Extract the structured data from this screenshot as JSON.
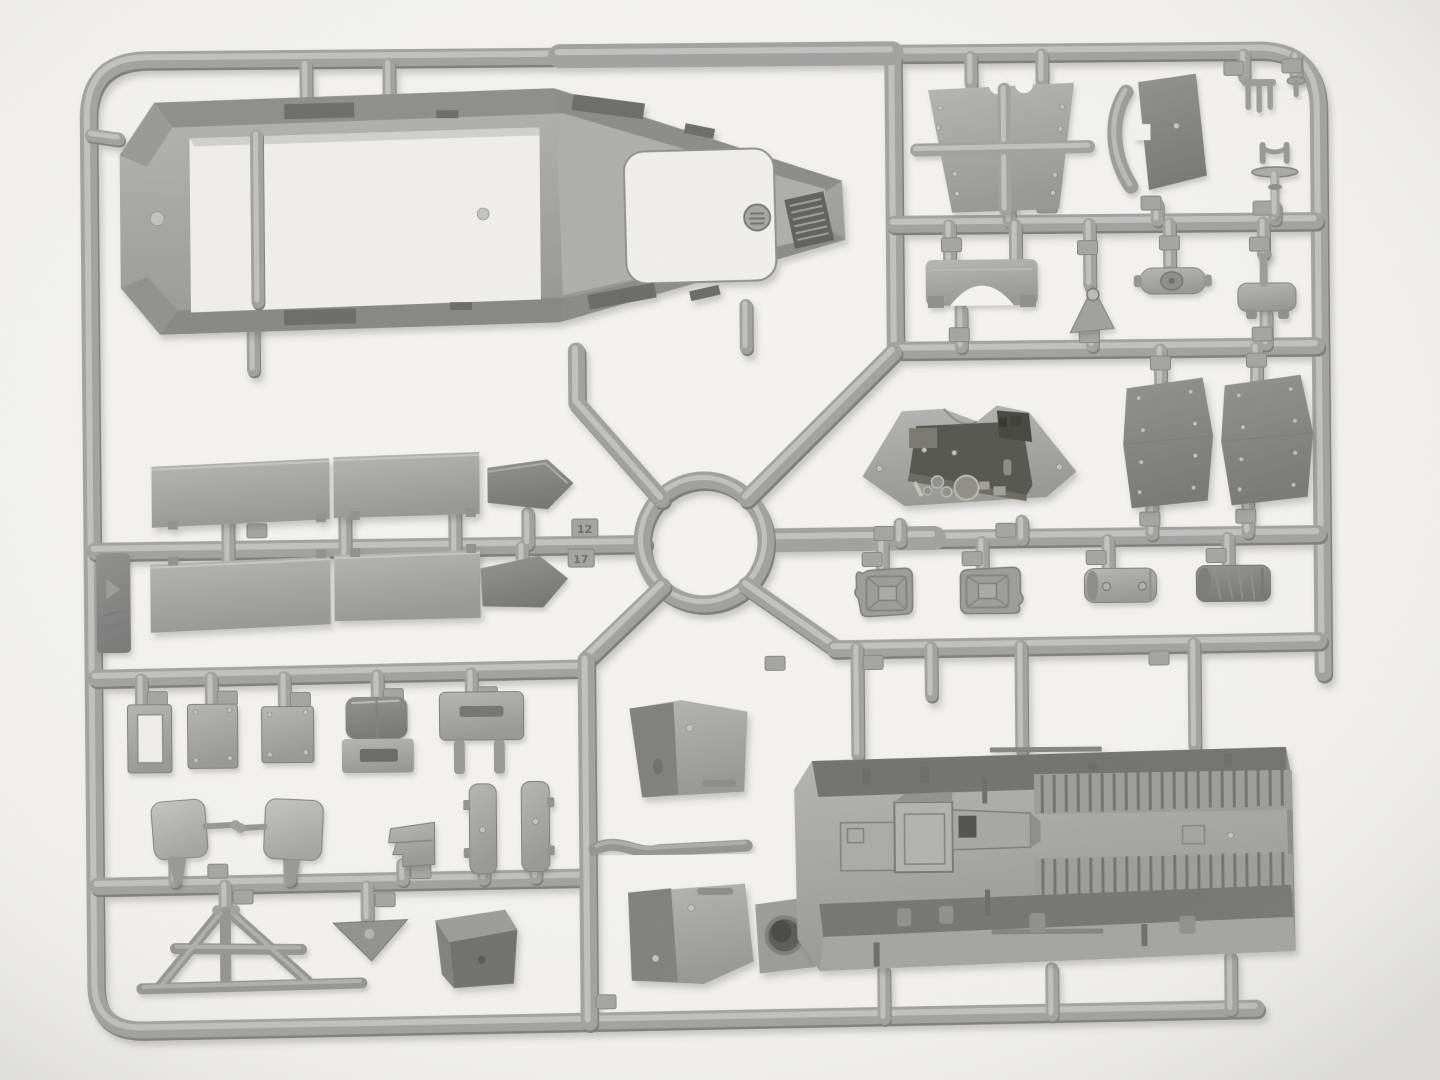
{
  "meta": {
    "description": "Product photograph of a gray injection-molded polystyrene model-kit sprue (parts frame) lying on a white background, soft studio light, subtle shadows under every part",
    "orientation": "landscape"
  },
  "palette": {
    "bg": "#f3f2f0",
    "base": "#a0a09e",
    "hi": "#c6c6c4",
    "mid": "#929290",
    "lo": "#7b7b79",
    "dark": "#666664",
    "open": "#efeeec",
    "vignette": "rgba(70,70,68,0.10)"
  },
  "sprue": {
    "material": "neutral gray styrene",
    "frame_shape": "rounded rectangular frame with internal runners, a central circular ring junction and four diagonal spokes",
    "tags": {
      "upper": "12",
      "lower": "17"
    },
    "parts": [
      {
        "id": "hull-roof-panel",
        "name": "large armored hull top panel with open interior and engine grille"
      },
      {
        "id": "windscreen-frame-plate",
        "name": "trapezoidal visor plate with cross brace"
      },
      {
        "id": "seat-back",
        "name": "seat backrest with curved strap"
      },
      {
        "id": "pedestal-mount",
        "name": "pedestal mount with disc base"
      },
      {
        "id": "pitchfork-clamp",
        "name": "three-tine clamp"
      },
      {
        "id": "small-stud",
        "name": "small flanged stud"
      },
      {
        "id": "bumper-bracket",
        "name": "arched bumper bracket"
      },
      {
        "id": "triangular-bracket",
        "name": "triangular bracket with eye"
      },
      {
        "id": "axle-housing",
        "name": "axle housing with center boss"
      },
      {
        "id": "foot-bracket",
        "name": "small footstep bracket"
      },
      {
        "id": "instrument-panel",
        "name": "driver instrument panel with dials"
      },
      {
        "id": "locker-door-left",
        "name": "stowage locker door"
      },
      {
        "id": "locker-door-right",
        "name": "stowage locker door"
      },
      {
        "id": "jerry-can-1",
        "name": "fuel canister"
      },
      {
        "id": "jerry-can-2",
        "name": "fuel canister"
      },
      {
        "id": "muffler-smooth",
        "name": "cylindrical muffler"
      },
      {
        "id": "muffler-wrapped",
        "name": "cylindrical muffler, wrapped"
      },
      {
        "id": "vision-flap-panels",
        "name": "four rectangular vision-flap panels"
      },
      {
        "id": "arrow-plate-1",
        "name": "pentagonal arrow plate"
      },
      {
        "id": "arrow-plate-2",
        "name": "pentagonal arrow plate"
      },
      {
        "id": "window-frame-plate",
        "name": "small open window frame"
      },
      {
        "id": "hatch-plate-1",
        "name": "small bolted plate"
      },
      {
        "id": "hatch-plate-2",
        "name": "small bolted plate"
      },
      {
        "id": "hood-bracket",
        "name": "hooded bracket with slot"
      },
      {
        "id": "slotted-mount",
        "name": "slotted mount plate with prongs"
      },
      {
        "id": "mirror-left",
        "name": "rear-view mirror with stem"
      },
      {
        "id": "mirror-right",
        "name": "rear-view mirror with stem"
      },
      {
        "id": "stepped-bracket",
        "name": "stepped bracket"
      },
      {
        "id": "door-plank-1",
        "name": "rounded door plank"
      },
      {
        "id": "door-plank-2",
        "name": "rounded door plank"
      },
      {
        "id": "folding-frame-stand",
        "name": "folding A-frame stand"
      },
      {
        "id": "warning-triangle",
        "name": "triangular plate with hole"
      },
      {
        "id": "visor-box",
        "name": "angled armored visor box"
      },
      {
        "id": "side-skirt-top",
        "name": "sloped side panel"
      },
      {
        "id": "side-skirt-bottom",
        "name": "sloped side panel with pivot hole"
      },
      {
        "id": "tow-bar",
        "name": "bent tow bar"
      },
      {
        "id": "fighting-compartment-floor",
        "name": "large interior floor with ribbed bench slats and engine box"
      },
      {
        "id": "molding-tab",
        "name": "dark embossed molding tab on left rail"
      }
    ]
  }
}
